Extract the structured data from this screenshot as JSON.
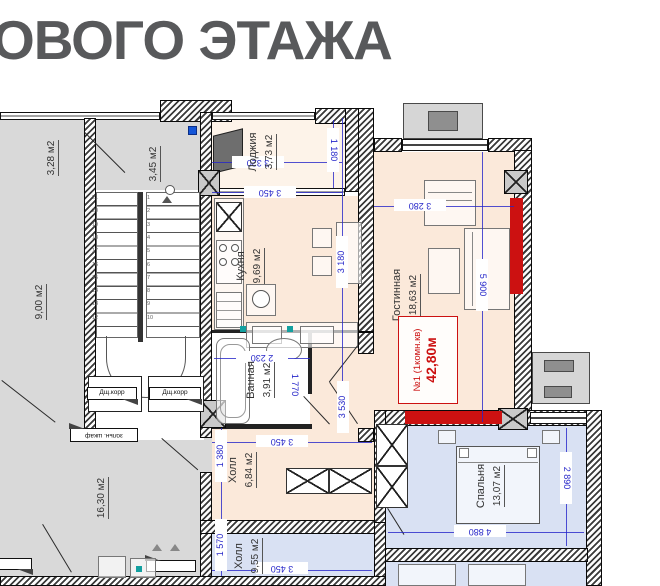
{
  "title": "ОВОГО ЭТАЖА",
  "apartment": {
    "number_line": "№1 (1комн.кв)",
    "area_line": "42,80м"
  },
  "rooms": {
    "loggia": {
      "name": "Лоджия",
      "area": "3,73 м2"
    },
    "kitchen": {
      "name": "Кухня",
      "area": "9,69 м2"
    },
    "living": {
      "name": "Гостинная",
      "area": "18,63 м2"
    },
    "bath": {
      "name": "Ванная",
      "area": "3,91 м2"
    },
    "hall1": {
      "name": "Холл",
      "area": "6,84 м2"
    },
    "hall2": {
      "name": "Холл",
      "area": "9,55 м2"
    },
    "bedroom": {
      "name": "Спальня",
      "area": "13,07 м2"
    },
    "service1": {
      "area": "9,00 м2"
    },
    "service2": {
      "area": "3,28 м2"
    },
    "service3": {
      "area": "3,45 м2"
    },
    "service4": {
      "area": "16,30 м2"
    }
  },
  "annotations": {
    "duct_left": "Дщ.корр",
    "duct_right": "Дщ.корр",
    "ash_cabinet": "зольн. шкаф"
  },
  "dimensions": {
    "loggia_width": "3 320",
    "loggia_depth": "1 180",
    "kitchen_width": "3 450",
    "kitchen_depth": "3 180",
    "living_width": "3 280",
    "living_height": "5 900",
    "bath_width": "2 230",
    "bath_depth": "1 770",
    "entry_depth": "3 530",
    "hall1_depth": "1 380",
    "hall1_width": "3 450",
    "hall2_depth": "1 570",
    "hall2_width": "3 450",
    "bedroom_width": "4 880",
    "bedroom_depth": "2 890"
  },
  "stairs": {
    "flight_left": [
      "21",
      "20",
      "19",
      "18",
      "17",
      "16",
      "15",
      "14",
      "13",
      "12"
    ],
    "flight_right": [
      "1",
      "2",
      "3",
      "4",
      "5",
      "6",
      "7",
      "8",
      "9",
      "10"
    ]
  },
  "colors": {
    "apartment_fill": "#fbe9da",
    "neighbor_fill": "#d9e1f3",
    "common_fill": "#d9d9d9",
    "dimension_blue": "#2626c9",
    "highlight_red": "#cc1111",
    "title_gray": "#58595b"
  }
}
